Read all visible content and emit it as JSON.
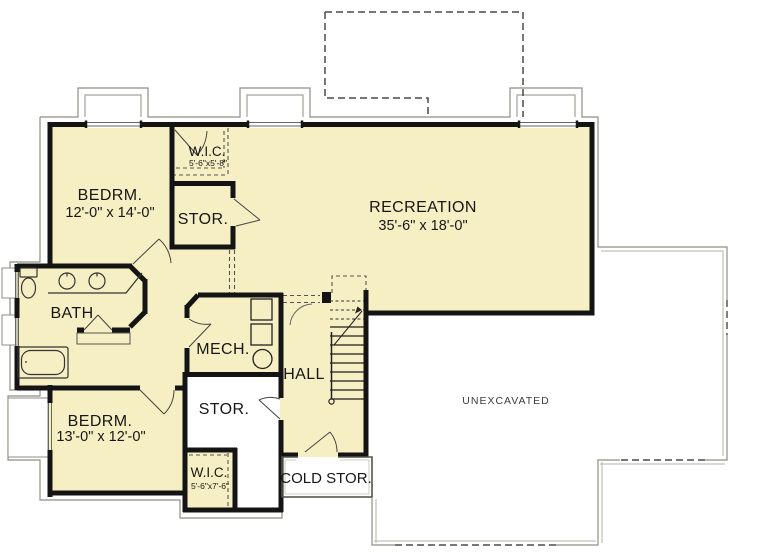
{
  "plan": {
    "rooms": [
      {
        "id": "bedroom1",
        "name": "BEDRM.",
        "dims": "12'-0\" x 14'-0\""
      },
      {
        "id": "wic1",
        "name": "W.I.C.",
        "dims": "5'-6\"x5'-8\""
      },
      {
        "id": "stor1",
        "name": "STOR."
      },
      {
        "id": "recreation",
        "name": "RECREATION",
        "dims": "35'-6\" x 18'-0\""
      },
      {
        "id": "bath",
        "name": "BATH"
      },
      {
        "id": "mech",
        "name": "MECH."
      },
      {
        "id": "hall",
        "name": "HALL"
      },
      {
        "id": "stor2",
        "name": "STOR."
      },
      {
        "id": "bedroom2",
        "name": "BEDRM.",
        "dims": "13'-0\" x 12'-0\""
      },
      {
        "id": "wic2",
        "name": "W.I.C.",
        "dims": "5'-6\"x7'-6\""
      },
      {
        "id": "cold_storage",
        "name": "COLD STOR."
      },
      {
        "id": "unexcavated",
        "name": "UNEXCAVATED"
      }
    ],
    "symbols": [
      "toilet",
      "double-vanity-sinks",
      "bathtub",
      "furnace-units",
      "water-heater",
      "staircase-up"
    ],
    "colors": {
      "floor_fill": "#f6efc3",
      "wall": "#141414",
      "thin_line": "#8f8f84",
      "dashed_line": "#4a4a4a",
      "text": "#161616",
      "background": "#ffffff"
    }
  }
}
